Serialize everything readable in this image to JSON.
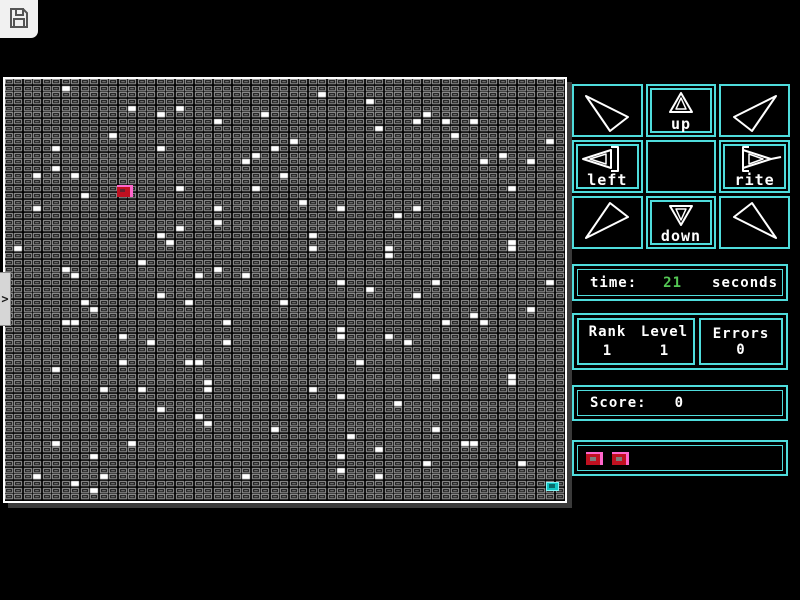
{
  "colors": {
    "cyan": "#4fdcdc",
    "green": "#55c855",
    "player_red": "#c01020",
    "player_pink": "#ff66cc",
    "goal_teal": "#12c4c4",
    "grid_cell_outline": "#b0b0b0",
    "grid_cell_inner": "#8c8c8c"
  },
  "toolbar": {
    "save_icon": "floppy-disk"
  },
  "sidebar_handle": {
    "glyph": ">"
  },
  "dpad": {
    "up_label": "up",
    "left_label": "left",
    "right_label": "rite",
    "down_label": "down"
  },
  "stats": {
    "time": {
      "label": "time:",
      "value": "21",
      "unit": "seconds"
    },
    "rank": {
      "label": "Rank",
      "value": "1"
    },
    "level": {
      "label": "Level",
      "value": "1"
    },
    "errors": {
      "label": "Errors",
      "value": "0"
    },
    "score": {
      "label": "Score:",
      "value": "0"
    },
    "lives": {
      "count": 2
    }
  },
  "grid": {
    "cols": 59,
    "rows": 63,
    "player": {
      "col": 12,
      "row": 16
    },
    "goal": {
      "col": 57,
      "row": 60
    },
    "white_cells": [
      [
        6,
        1
      ],
      [
        13,
        4
      ],
      [
        18,
        4
      ],
      [
        16,
        5
      ],
      [
        27,
        5
      ],
      [
        22,
        6
      ],
      [
        11,
        8
      ],
      [
        5,
        10
      ],
      [
        16,
        10
      ],
      [
        28,
        10
      ],
      [
        26,
        11
      ],
      [
        25,
        12
      ],
      [
        5,
        13
      ],
      [
        3,
        14
      ],
      [
        7,
        14
      ],
      [
        29,
        14
      ],
      [
        18,
        16
      ],
      [
        26,
        16
      ],
      [
        8,
        17
      ],
      [
        3,
        19
      ],
      [
        22,
        19
      ],
      [
        22,
        21
      ],
      [
        18,
        22
      ],
      [
        16,
        23
      ],
      [
        17,
        24
      ],
      [
        1,
        25
      ],
      [
        14,
        27
      ],
      [
        6,
        28
      ],
      [
        22,
        28
      ],
      [
        7,
        29
      ],
      [
        25,
        29
      ],
      [
        20,
        29
      ],
      [
        33,
        2
      ],
      [
        38,
        3
      ],
      [
        44,
        5
      ],
      [
        43,
        6
      ],
      [
        46,
        6
      ],
      [
        49,
        6
      ],
      [
        39,
        7
      ],
      [
        47,
        8
      ],
      [
        30,
        9
      ],
      [
        57,
        9
      ],
      [
        52,
        11
      ],
      [
        50,
        12
      ],
      [
        55,
        12
      ],
      [
        53,
        16
      ],
      [
        31,
        18
      ],
      [
        35,
        19
      ],
      [
        43,
        19
      ],
      [
        41,
        20
      ],
      [
        32,
        23
      ],
      [
        53,
        24
      ],
      [
        32,
        25
      ],
      [
        40,
        25
      ],
      [
        53,
        25
      ],
      [
        40,
        26
      ],
      [
        35,
        30
      ],
      [
        45,
        30
      ],
      [
        57,
        30
      ],
      [
        38,
        31
      ],
      [
        16,
        32
      ],
      [
        8,
        33
      ],
      [
        19,
        33
      ],
      [
        29,
        33
      ],
      [
        9,
        34
      ],
      [
        6,
        36
      ],
      [
        7,
        36
      ],
      [
        23,
        36
      ],
      [
        12,
        38
      ],
      [
        15,
        39
      ],
      [
        23,
        39
      ],
      [
        12,
        42
      ],
      [
        19,
        42
      ],
      [
        20,
        42
      ],
      [
        5,
        43
      ],
      [
        21,
        45
      ],
      [
        10,
        46
      ],
      [
        14,
        46
      ],
      [
        21,
        46
      ],
      [
        16,
        49
      ],
      [
        20,
        50
      ],
      [
        21,
        51
      ],
      [
        28,
        52
      ],
      [
        5,
        54
      ],
      [
        13,
        54
      ],
      [
        9,
        56
      ],
      [
        3,
        59
      ],
      [
        10,
        59
      ],
      [
        25,
        59
      ],
      [
        7,
        60
      ],
      [
        9,
        61
      ],
      [
        43,
        32
      ],
      [
        55,
        34
      ],
      [
        49,
        35
      ],
      [
        46,
        36
      ],
      [
        50,
        36
      ],
      [
        35,
        37
      ],
      [
        35,
        38
      ],
      [
        40,
        38
      ],
      [
        42,
        39
      ],
      [
        37,
        42
      ],
      [
        45,
        44
      ],
      [
        53,
        44
      ],
      [
        53,
        45
      ],
      [
        32,
        46
      ],
      [
        35,
        47
      ],
      [
        41,
        48
      ],
      [
        45,
        52
      ],
      [
        36,
        53
      ],
      [
        48,
        54
      ],
      [
        49,
        54
      ],
      [
        39,
        55
      ],
      [
        35,
        56
      ],
      [
        44,
        57
      ],
      [
        54,
        57
      ],
      [
        35,
        58
      ],
      [
        39,
        59
      ]
    ]
  }
}
